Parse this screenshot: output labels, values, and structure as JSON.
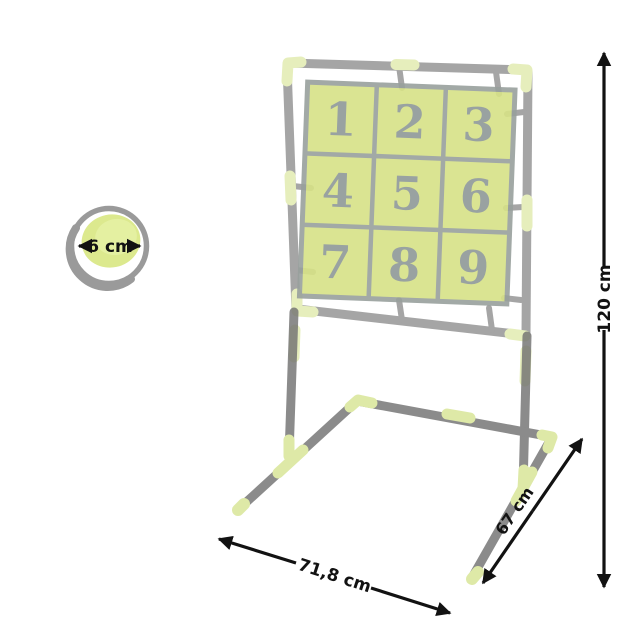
{
  "ball": {
    "diameter_label": "6 cm"
  },
  "grid": {
    "cells": [
      "1",
      "2",
      "3",
      "4",
      "5",
      "6",
      "7",
      "8",
      "9"
    ]
  },
  "dimensions": {
    "height_label": "120 cm",
    "depth_label": "67 cm",
    "width_label": "71,8 cm"
  },
  "colors": {
    "panel_green": "#d7e287",
    "ball_green": "#dce98e",
    "connector_green": "#d7e594",
    "tube_gray": "#8d8d8d",
    "number_gray": "#8e9997",
    "dimension_black": "#121212"
  }
}
